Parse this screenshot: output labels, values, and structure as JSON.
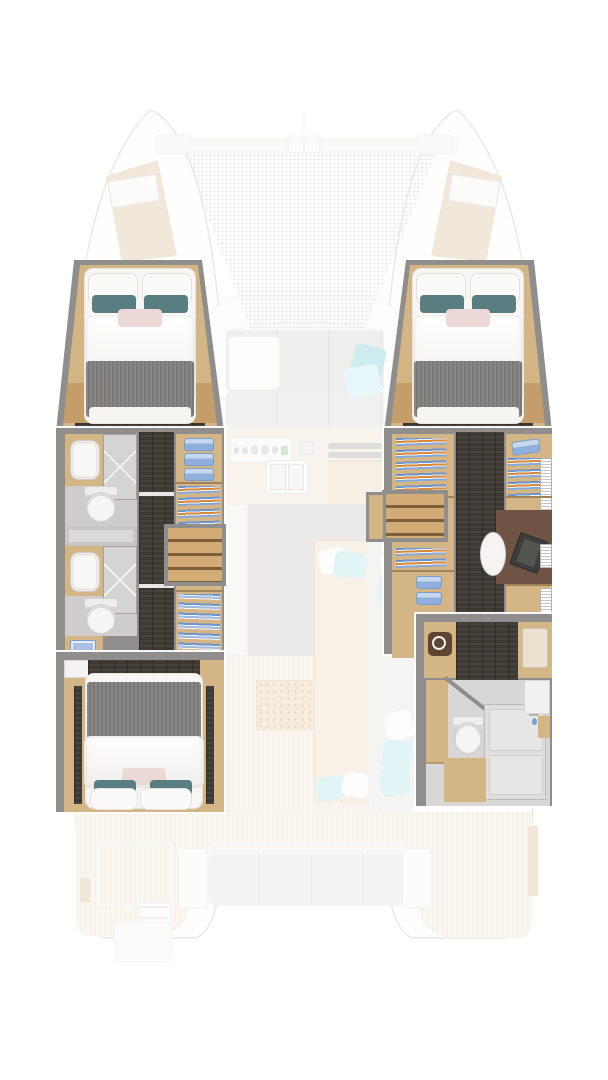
{
  "document": {
    "type": "catamaran-yacht-deck-plan",
    "view": "top-down floor plan, bow up",
    "visible_text": [],
    "highlight_note": "hull interiors rendered full-color; exterior decks, saloon and cockpit shown faded"
  },
  "palette": {
    "background": "#ffffff",
    "wall_grey": "#8f8e8c",
    "hull_outline": "#c8c8c6",
    "wood_cabinet": "#d4b585",
    "wood_bench": "#c49d6b",
    "floor_dark_walnut": "#413b36",
    "bathroom_floor": "#cecdcb",
    "shower_grey": "#d4d4d2",
    "bed_blanket_grey": "#7f7e7c",
    "bedding_white": "#f7f6f3",
    "pillow_teal": "#587e82",
    "pillow_blush": "#ecd9d7",
    "towel_blue": "#8fb0dc",
    "hanger_blue": "#6b95cf",
    "hanger_orange": "#d78a3e",
    "aqua_cushion": "#b5e6ea",
    "teal_cushion": "#7fcbd5",
    "teak_deck": "#ece2d0",
    "saloon_floor": "#cbcac8",
    "sofa_grey": "#d7d7d5",
    "desk_rug_brown": "#6f5445",
    "washer_door_brown": "#5f4430",
    "bow_deck_beige": "#dcc49e",
    "faded_opacity": 0.38
  },
  "floorplan": {
    "port_hull": {
      "rooms": [
        {
          "name": "forward-cabin",
          "fixtures": [
            "double-berth",
            "white-pillows",
            "teal-pillows",
            "blush-pillow",
            "grey-blanket",
            "side-benches"
          ]
        },
        {
          "name": "forward-bathroom",
          "fixtures": [
            "washbasin",
            "shower",
            "toilet"
          ]
        },
        {
          "name": "aft-bathroom",
          "fixtures": [
            "washbasin",
            "shower",
            "toilet",
            "cabinet"
          ]
        },
        {
          "name": "corridor",
          "fixtures": [
            "dark-walnut-sole",
            "door-thresholds"
          ]
        },
        {
          "name": "wardrobe-column",
          "fixtures": [
            "towel-shelves",
            "hanging-locker",
            "hanging-locker"
          ]
        },
        {
          "name": "companionway-steps"
        },
        {
          "name": "aft-cabin",
          "fixtures": [
            "double-berth",
            "white-pillows",
            "teal-pillows",
            "blush-pillow",
            "grey-blanket",
            "corner-counter"
          ]
        }
      ]
    },
    "starboard_hull": {
      "rooms": [
        {
          "name": "forward-cabin",
          "fixtures": [
            "double-berth",
            "white-pillows",
            "teal-pillows",
            "blush-pillow",
            "grey-blanket",
            "side-benches"
          ]
        },
        {
          "name": "dressing-area",
          "fixtures": [
            "hanging-locker",
            "towel-shelves",
            "towel-shelf"
          ]
        },
        {
          "name": "companionway-steps"
        },
        {
          "name": "office-area",
          "fixtures": [
            "desk",
            "laptop",
            "desk-chair",
            "book-shelves",
            "brown-rug"
          ]
        },
        {
          "name": "utility",
          "fixtures": [
            "washing-machine"
          ]
        },
        {
          "name": "aft-bathroom",
          "fixtures": [
            "toilet",
            "shower",
            "vanity-washbasin",
            "cabinets",
            "angled-partition"
          ]
        }
      ]
    },
    "center_faded": {
      "bow": [
        "trampoline-net",
        "forward-crossbeam",
        "deck-hatches",
        "bow-lockers"
      ],
      "saloon": [
        "l-shaped-sofa",
        "coffee-table",
        "teal-throw-pillows",
        "galley-counter",
        "stove-burners",
        "double-sink",
        "sideboard",
        "grey-sole"
      ],
      "cockpit": [
        "daybed",
        "chaise-lounge",
        "aqua-pillows",
        "perforated-doormat",
        "teak-deck",
        "aft-bench",
        "side-tables",
        "transom-gate",
        "swim-ladder",
        "stern-platforms"
      ]
    }
  }
}
